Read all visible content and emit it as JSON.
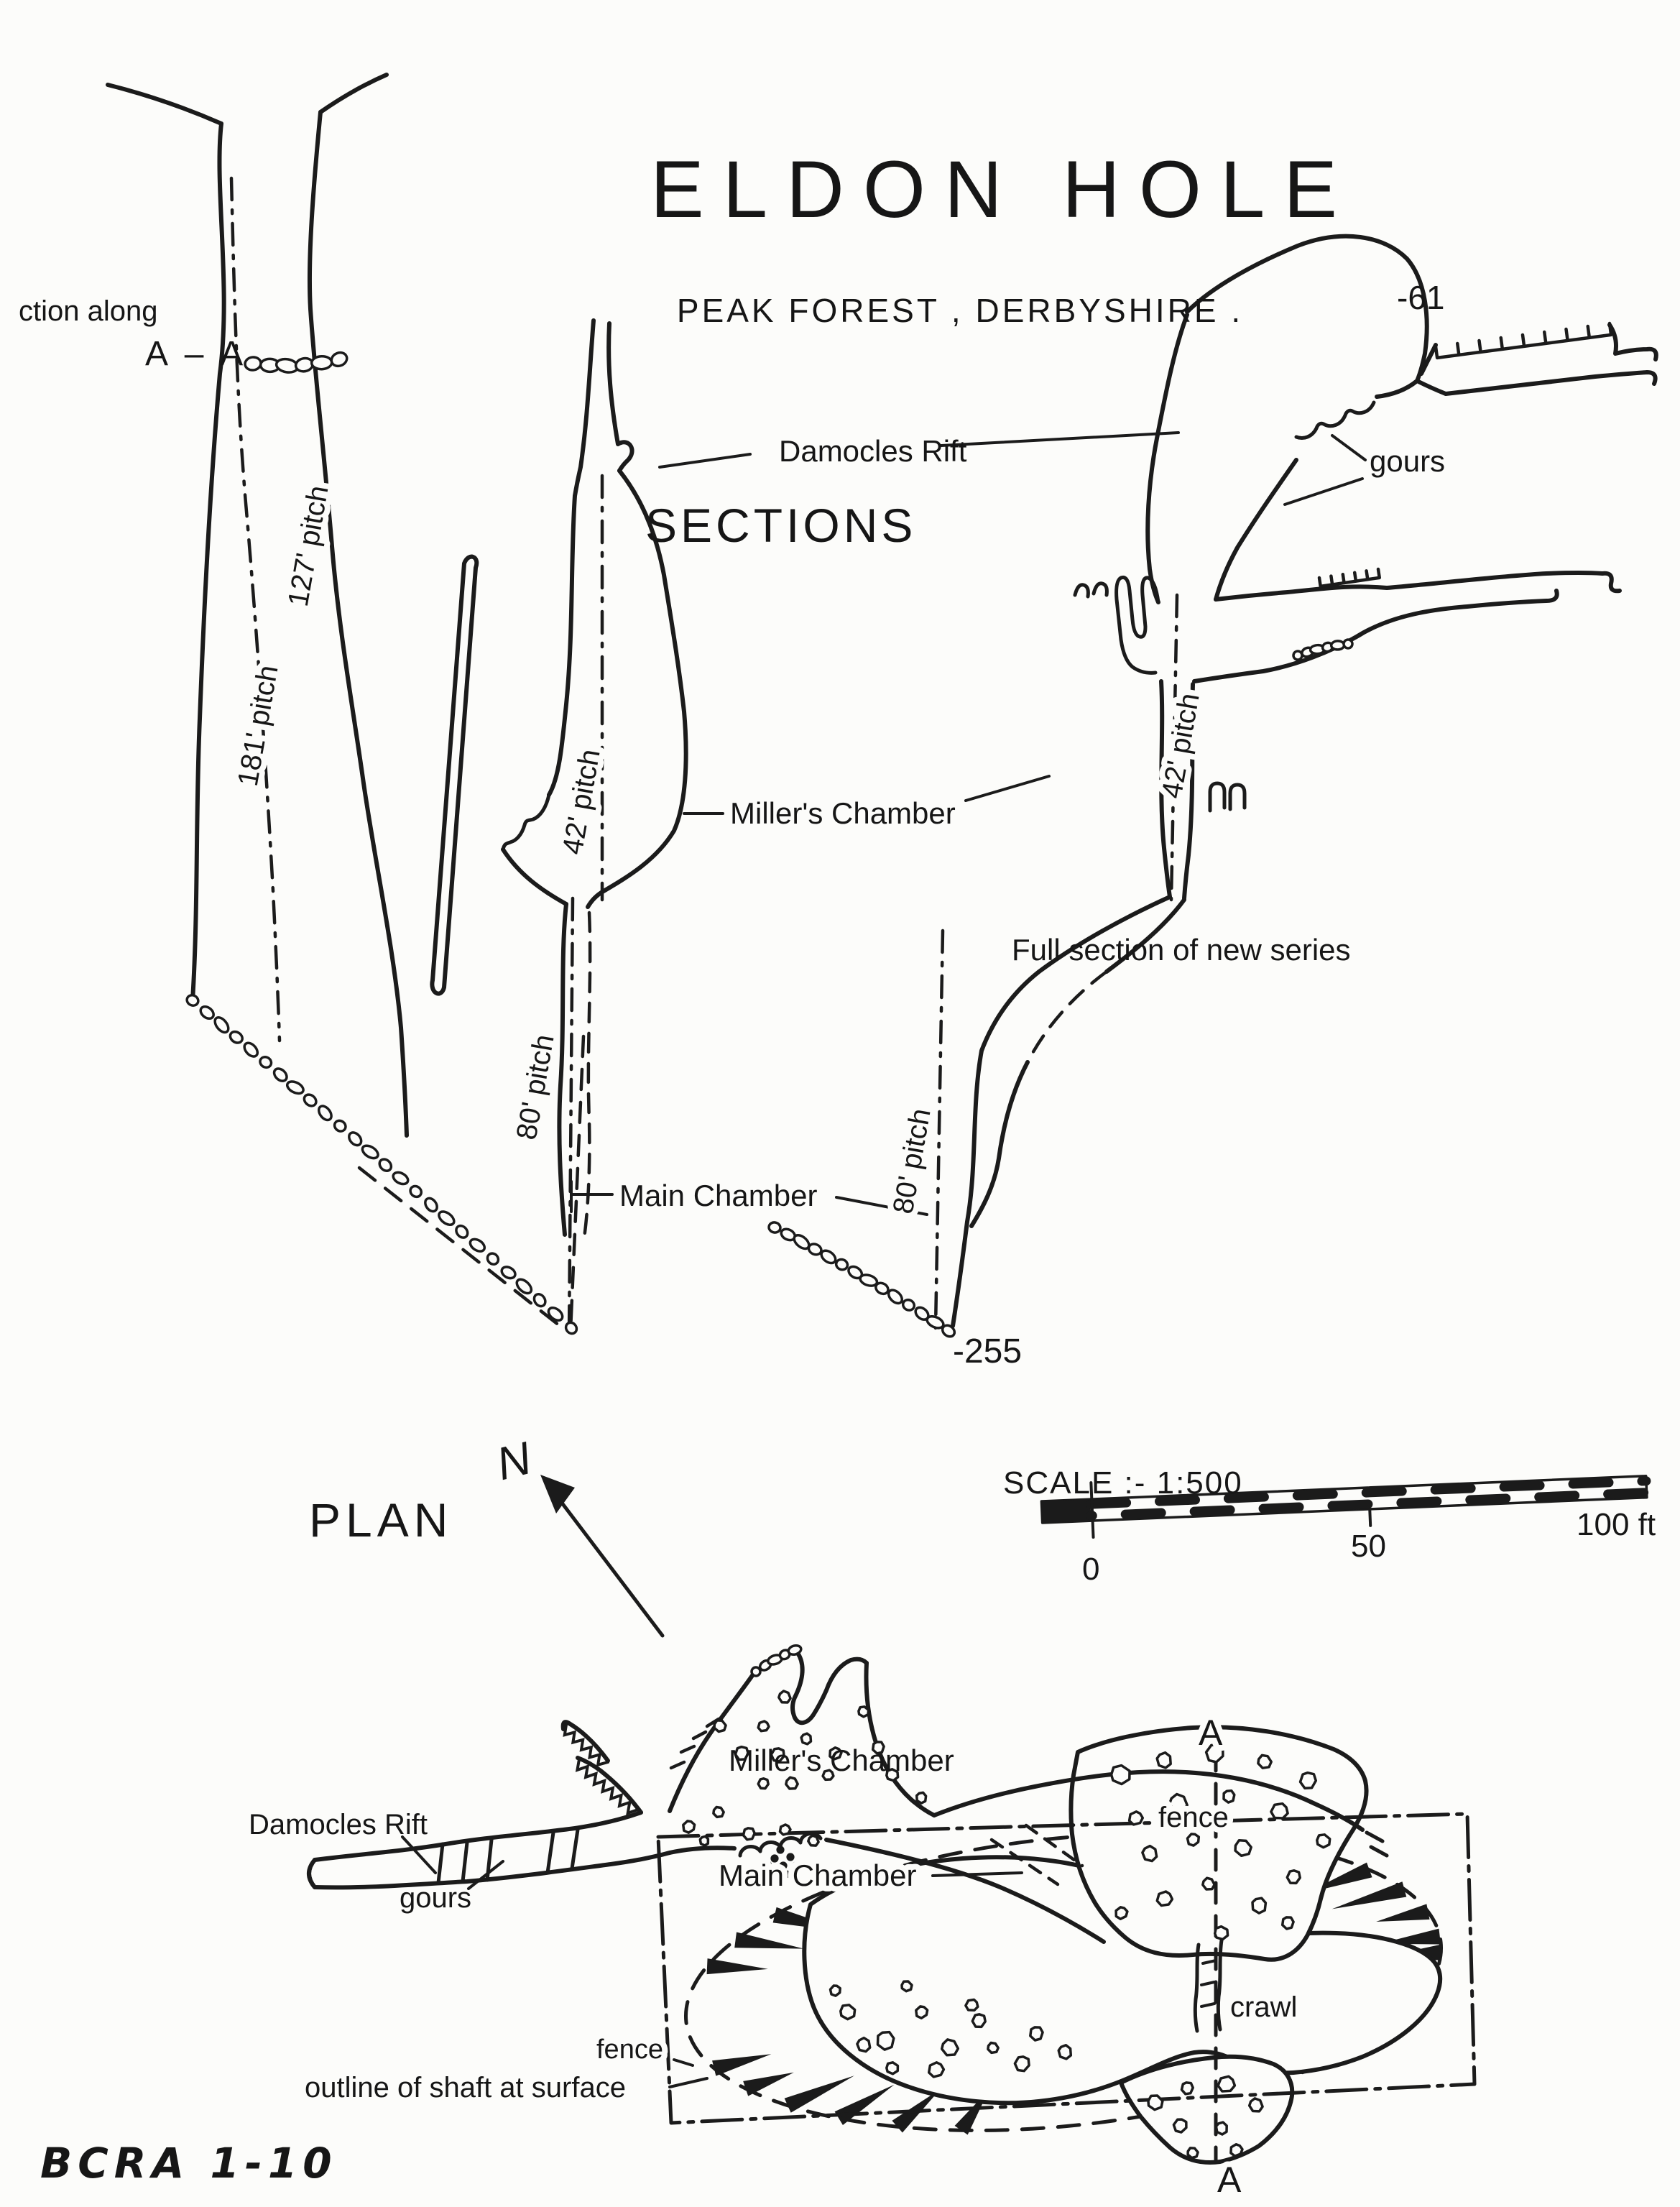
{
  "title": "ELDON HOLE",
  "subtitle": "PEAK  FOREST , DERBYSHIRE .",
  "sections": {
    "heading": "SECTIONS",
    "note_line1": "ction along",
    "note_line2": "A – A",
    "labels": {
      "damocles_rift": "Damocles Rift",
      "gours": "gours",
      "millers_chamber": "Miller's Chamber",
      "full_section": "Full section of new series",
      "main_chamber": "Main Chamber",
      "depth_top": "-61",
      "depth_bottom": "-255",
      "pitch_127": "127' pitch",
      "pitch_181": "181' pitch",
      "pitch_42_left": "42' pitch",
      "pitch_42_right": "42' pitch",
      "pitch_80_left": "80' pitch",
      "pitch_80_right": "80' pitch"
    }
  },
  "plan": {
    "heading": "PLAN",
    "north_letter": "N",
    "scale": {
      "label": "SCALE :- 1:500",
      "tick_0": "0",
      "tick_50": "50",
      "tick_100": "100 ft"
    },
    "labels": {
      "damocles_rift": "Damocles Rift",
      "gours": "gours",
      "millers_chamber": "Miller's Chamber",
      "main_chamber": "Main Chamber",
      "fence": "fence",
      "fence_left": "fence",
      "crawl": "crawl",
      "shaft_outline": "outline of shaft at surface",
      "section_a_top": "A",
      "section_a_bottom": "A"
    }
  },
  "footer": {
    "credit": "BCRA 1-10"
  }
}
